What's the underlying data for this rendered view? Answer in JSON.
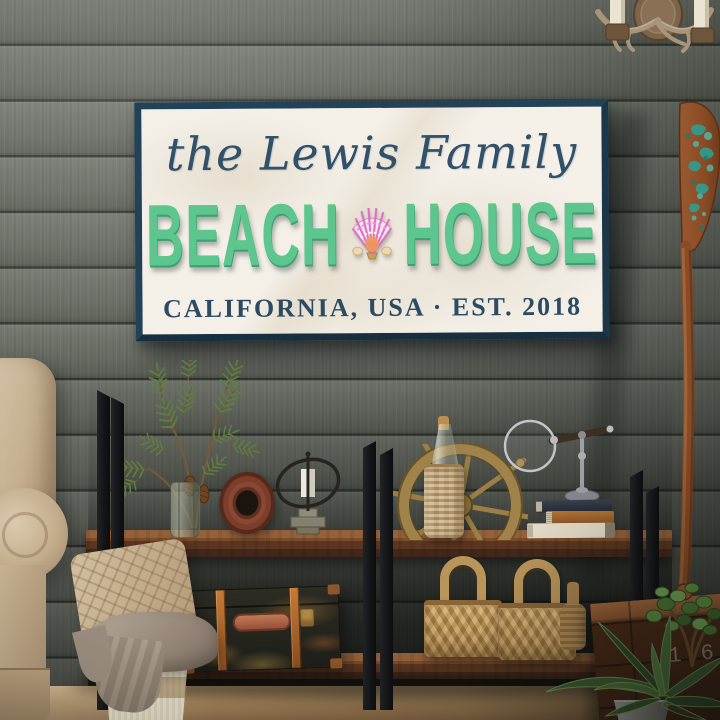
{
  "sign": {
    "family_line": "the Lewis Family",
    "word_beach": "BEACH",
    "word_house": "HOUSE",
    "location_line": "CALIFORNIA, USA · EST. 2018",
    "colors": {
      "frame_navy": "#214258",
      "face_marble": "#f4f0e8",
      "script_navy": "#31506a",
      "letter_green": "#5cc68e",
      "serif_navy": "#2c4b63",
      "shell_pink": "#db6fc0"
    }
  },
  "crate": {
    "stencil": "1.6"
  },
  "palette": {
    "wall_plank": "#6a6e65",
    "wall_gap": "#2e322b",
    "shelf_wood": "#7c4c2a",
    "metal_frame": "#141518",
    "floor_wood": "#a5855c",
    "armchair_beige": "#c4ae8f",
    "basket_wicker": "#b8935a",
    "oar_wood": "#8a4c26",
    "oar_teal_paint": "#2f9e93",
    "pine_green": "#5e7d42",
    "agave_green": "#3c5c30"
  },
  "items": [
    "antler-candle-sconce",
    "beach-house-sign",
    "scallop-shell-icon",
    "pine-sprig-vase",
    "driftwood-ring",
    "armillary-candle-holder",
    "ship-wheel",
    "wicker-wrapped-bottle",
    "magnifying-glass-stand",
    "stacked-books",
    "vintage-trunk",
    "wicker-baskets",
    "wicker-jug",
    "console-table",
    "wooden-paddle-oar",
    "storage-crate",
    "jade-plant",
    "agave-plant",
    "armchair",
    "throw-pillow",
    "blanket",
    "floor-basket"
  ]
}
